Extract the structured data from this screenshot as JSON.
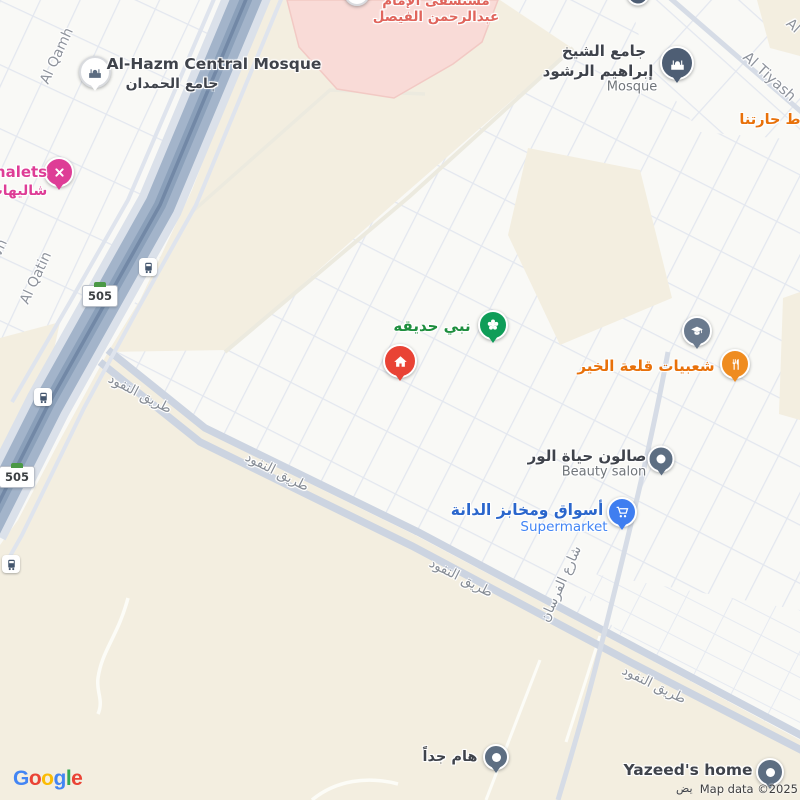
{
  "attribution": {
    "logo": [
      {
        "ch": "G",
        "color": "#4285F4"
      },
      {
        "ch": "o",
        "color": "#EA4335"
      },
      {
        "ch": "o",
        "color": "#FBBC05"
      },
      {
        "ch": "g",
        "color": "#4285F4"
      },
      {
        "ch": "l",
        "color": "#34A853"
      },
      {
        "ch": "e",
        "color": "#EA4335"
      }
    ],
    "map_data": "Map data ©2025",
    "partial_arabic": "يض"
  },
  "streets": {
    "al_qamh": "Al Qamh",
    "al_qatin": "Al Qatin",
    "vn_partial": "vn",
    "al_tiyash": "Al Tiyash",
    "al_partial": "Al",
    "route_505": "505",
    "al_nufud_road": "طريق النفود",
    "al_forsan_street": "شارع الفرسان"
  },
  "pois": {
    "alhazm_mosque": {
      "name": "Al-Hazm Central Mosque",
      "name_ar": "جامع الحمدان"
    },
    "chalets": {
      "name_partial": "halets",
      "name_ar": "شاليهات"
    },
    "hospital": {
      "line1": "مستشفى الإمام",
      "line2": "عبدالرحمن الفيصل"
    },
    "sheikh_mosque": {
      "line1": "جامع الشيخ",
      "line2": "إبراهيم الرشود",
      "subtitle": "Mosque"
    },
    "haratna": {
      "name": "ط حارتنا"
    },
    "park": {
      "name": "نبي حديقه"
    },
    "restaurant": {
      "name": "شعبيات قلعة الخير"
    },
    "beauty_salon": {
      "name": "صالون حياة الور",
      "subtitle": "Beauty salon"
    },
    "supermarket": {
      "name": "أسواق ومخابز الدانة",
      "subtitle": "Supermarket"
    },
    "important": {
      "name": "هام جداً"
    },
    "yazeeds_home": {
      "name": "Yazeed's home"
    }
  },
  "icons": {
    "mosque": "mosque-icon",
    "chalet": "crossed-paddles-icon",
    "park": "flower-icon",
    "home_marker": "home-icon",
    "school": "graduation-cap-icon",
    "restaurant": "fork-knife-icon",
    "supermarket": "shopping-cart-icon",
    "transit": "bus-icon",
    "dot_pin": "dot-icon"
  },
  "colors": {
    "land_beige": "#f3eee0",
    "urban_white": "#f9f9f6",
    "hospital_pink": "#f9dbd7",
    "highway": "#a3b4ca",
    "road": "#ccd4e1",
    "pin_red": "#e94335",
    "pin_green": "#0f9d58",
    "pin_orange": "#ef8c20",
    "pin_blue": "#3f7ef0",
    "pin_pink": "#de3d96",
    "pin_slate": "#4e5e74",
    "route_green": "#4b9946"
  }
}
